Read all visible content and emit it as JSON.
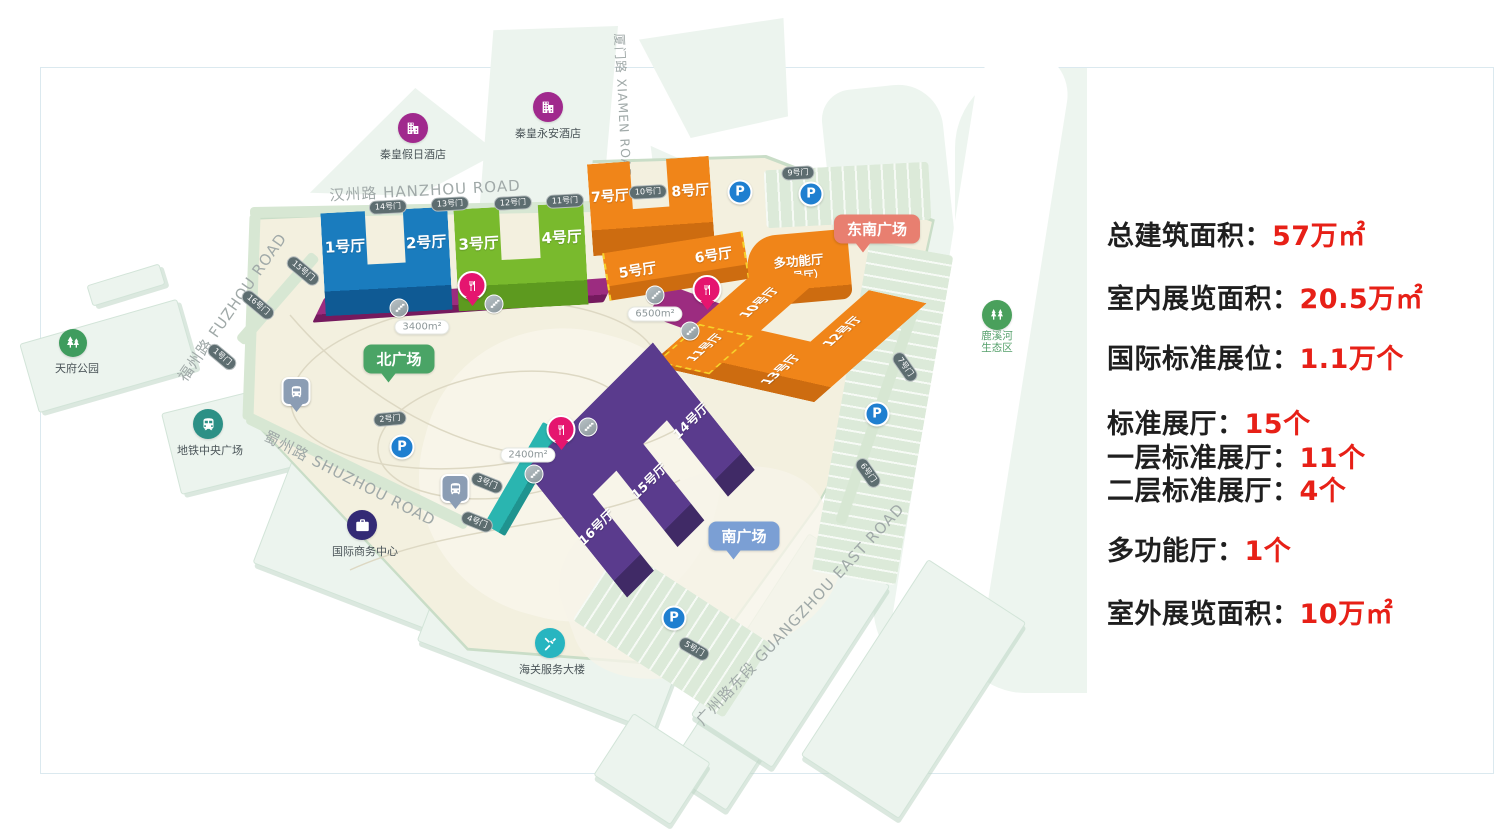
{
  "stats": {
    "items": [
      {
        "label": "总建筑面积：",
        "value": "57万㎡"
      },
      {
        "label": "室内展览面积：",
        "value": "20.5万㎡"
      },
      {
        "label": "国际标准展位：",
        "value": "1.1万个"
      },
      {
        "label": "标准展厅：",
        "value": "15个"
      },
      {
        "label": "一层标准展厅：",
        "value": "11个"
      },
      {
        "label": "二层标准展厅：",
        "value": "4个"
      },
      {
        "label": "多功能厅：",
        "value": "1个"
      },
      {
        "label": "室外展览面积：",
        "value": "10万㎡"
      }
    ]
  },
  "map": {
    "roads": {
      "hanzhou": "汉州路 HANZHOU ROAD",
      "fuzhou": "福州路 FUZHOU ROAD",
      "xiamen": "厦门路 XIAMEN ROAD",
      "shuzhou": "蜀州路 SHUZHOU ROAD",
      "guangzhou": "广州路东段 GUANGZHOU EAST ROAD"
    },
    "halls": {
      "h1": "1号厅",
      "h2": "2号厅",
      "h3": "3号厅",
      "h4": "4号厅",
      "h5": "5号厅",
      "h6": "6号厅",
      "h7": "7号厅",
      "h8": "8号厅",
      "h10": "10号厅",
      "h11": "11号厅",
      "h12": "12号厅",
      "h13": "13号厅",
      "h14": "14号厅",
      "h15": "15号厅",
      "h16": "16号厅",
      "multi_name": "多功能厅",
      "multi_sub": "（9号厅）"
    },
    "gates": {
      "g1": "1号门",
      "g2": "2号门",
      "g3": "3号门",
      "g4": "4号门",
      "g5": "5号门",
      "g6": "6号门",
      "g7": "7号门",
      "g9": "9号门",
      "g10": "10号门",
      "g11": "11号门",
      "g12": "12号门",
      "g13": "13号门",
      "g14": "14号门",
      "g15": "15号门",
      "g16": "16号门"
    },
    "landmarks": {
      "park": "天府公园",
      "metro": "地铁中央广场",
      "business": "国际商务中心",
      "customs": "海关服务大楼",
      "hotel_holiday": "秦皇假日酒店",
      "hotel_yongan": "秦皇永安酒店",
      "eco": "鹿溪河\n生态区"
    },
    "plazas": {
      "north": "北广场",
      "southeast": "东南广场",
      "south": "南广场"
    },
    "areas": {
      "a3400": "3400m²",
      "a6500": "6500m²",
      "a2400": "2400m²"
    },
    "parking": "P"
  },
  "colors": {
    "accent_red": "#e72017",
    "hall_blue": "#1a7cbe",
    "hall_green": "#79ba2d",
    "hall_orange": "#f08519",
    "hall_purple": "#5a3b8d",
    "strip_magenta": "#9c2c80",
    "strip_teal": "#2ab5b0",
    "plaza_north": "#4aa466",
    "plaza_southeast": "#e87f70",
    "plaza_south": "#7b9fd4"
  }
}
